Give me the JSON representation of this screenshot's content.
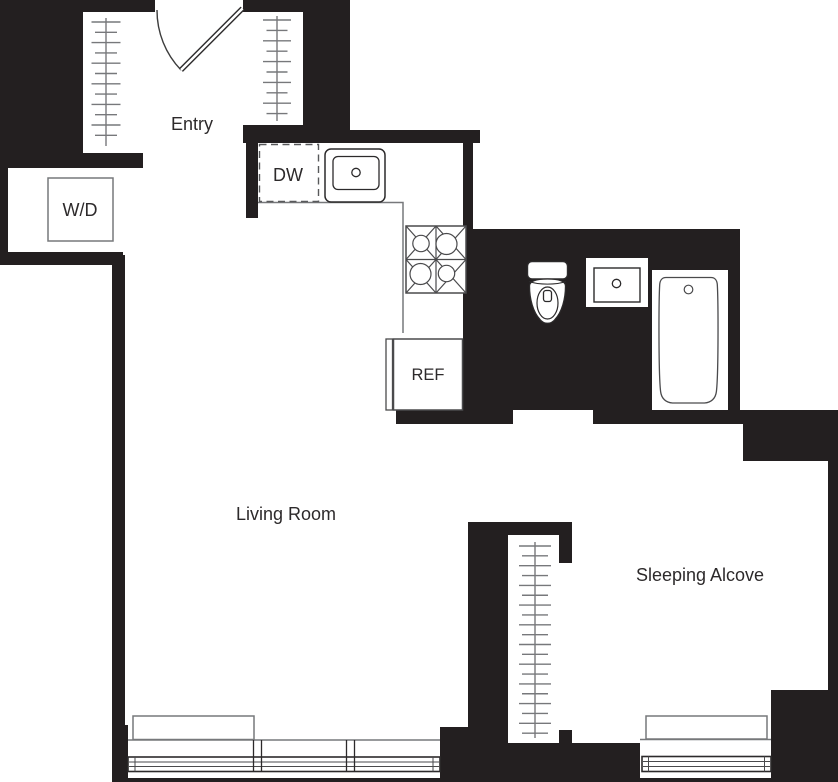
{
  "floorplan": {
    "labels": {
      "entry": "Entry",
      "living_room": "Living Room",
      "sleeping_alcove": "Sleeping Alcove",
      "washer_dryer": "W/D",
      "dishwasher": "DW",
      "refrigerator": "REF"
    },
    "colors": {
      "walls": "#231f20",
      "fixture_stroke": "#4a4a4c",
      "light_stroke": "#77787b",
      "background": "#ffffff"
    }
  }
}
